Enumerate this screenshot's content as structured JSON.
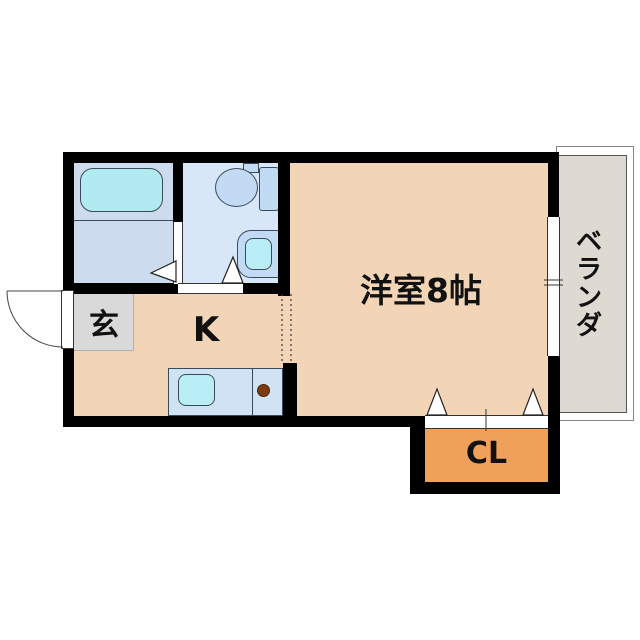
{
  "rooms": {
    "western_room": {
      "label": "洋室8帖"
    },
    "kitchen": {
      "label": "K"
    },
    "entrance": {
      "label": "玄"
    },
    "closet": {
      "label": "CL"
    },
    "balcony": {
      "label": "ベランダ"
    }
  },
  "colors": {
    "wall": "#000000",
    "room_floor": "#f2d4b6",
    "closet_floor": "#f0a159",
    "entrance_floor": "#d9d9d9",
    "bathroom_floor": "#ccdcee",
    "toilet_floor": "#d8e7f7",
    "counter": "#cfe3f4",
    "bathtub": "#b2eaf2",
    "sink": "#baeef6",
    "fixture": "#c2daf4",
    "balcony_floor": "#ded9d1",
    "burner": "#7c3a10",
    "text": "#111111",
    "background": "#ffffff"
  }
}
